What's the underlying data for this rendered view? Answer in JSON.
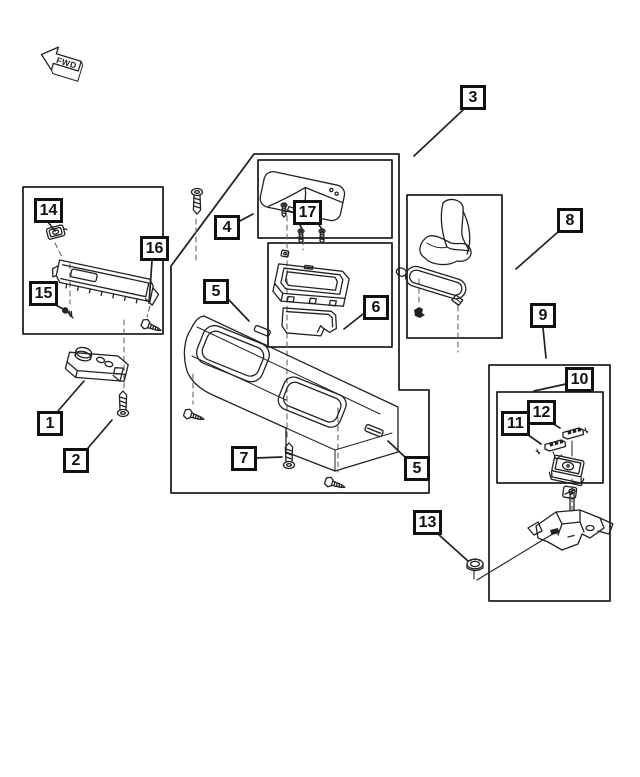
{
  "diagram": {
    "type": "exploded-parts-diagram",
    "direction_indicator": {
      "label": "FWD"
    }
  },
  "colors": {
    "background": "#ffffff",
    "line": "#222222",
    "box_border": "#111111",
    "dashed_line": "#666666"
  },
  "callouts": [
    {
      "label": "1"
    },
    {
      "label": "2"
    },
    {
      "label": "3"
    },
    {
      "label": "4"
    },
    {
      "label": "5"
    },
    {
      "label": "5"
    },
    {
      "label": "6"
    },
    {
      "label": "7"
    },
    {
      "label": "8"
    },
    {
      "label": "9"
    },
    {
      "label": "10"
    },
    {
      "label": "11"
    },
    {
      "label": "12"
    },
    {
      "label": "13"
    },
    {
      "label": "14"
    },
    {
      "label": "15"
    },
    {
      "label": "16"
    },
    {
      "label": "17"
    }
  ]
}
